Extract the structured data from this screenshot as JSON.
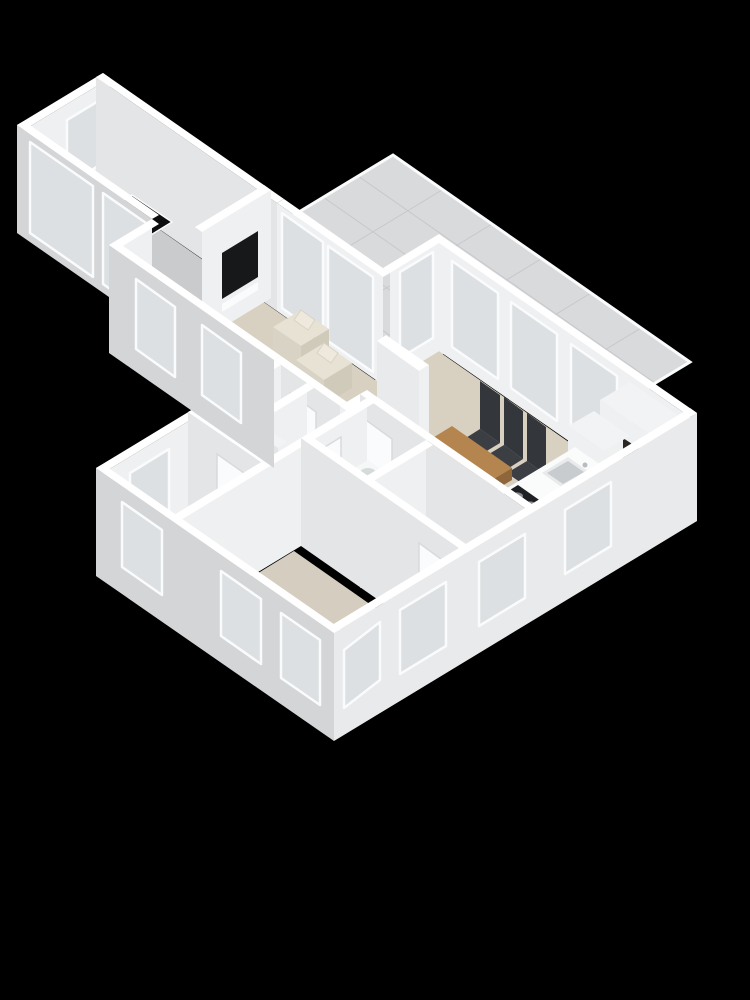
{
  "scene": {
    "type": "3d-floorplan-render",
    "view": "isometric-top",
    "background": "#000000",
    "description": "3D rendered floor plan of an apartment on black background: large tiled roof terrace top-right, narrow study wing on the left, open living/dining/kitchen area in the middle, hallway with stairs, WC, utility room, bathroom and two bedrooms in the lower block."
  },
  "palette": {
    "bg": "#000000",
    "wall_top": "#ffffff",
    "wall_int": "#eff0f1",
    "wall_int_shade": "#e3e5e7",
    "wall_sw": "#d3d5d7",
    "wall_se": "#e9eaeb",
    "frame": "#fafbfc",
    "glass": "#dde0e2",
    "terrace_tile": "#d9dadc",
    "terrace_grid": "#c6c8cb",
    "floor_living": "#d8d1c2",
    "floor_wing": "#c9cbcc",
    "floor_hall": "#cdc5b6",
    "floor_bed1": "#d3ccbd",
    "floor_bed2": "#d5cec0",
    "floor_utility": "#c5c7c9",
    "floor_bath": "#c8cacc",
    "floor_wc": "#c2c4c6",
    "rug": "#c6c7c5",
    "sofa": "#b7bbbe",
    "sofa_side": "#aeb2b5",
    "armchair": "#e7e2d4",
    "armchair_shade": "#d8d3c4",
    "armchair_side": "#cfcaba",
    "wood": "#b5854f",
    "wood_dark": "#96693f",
    "wood_side": "#8e6639",
    "chair_dark": "#3b3e42",
    "chair_darker": "#33363a",
    "tv": "#17181a",
    "counter": "#fafbfb",
    "stove": "#1e2023",
    "oven": "#2a2624",
    "desk_top": "#0d0e10",
    "appliance": "#f2f3f4"
  },
  "rooms": [
    {
      "name": "roof-terrace",
      "floor": "terrace_tile",
      "features": "tiled surface with grid joints"
    },
    {
      "name": "study-wing",
      "floor": "floor_wing",
      "features": "drafting desk, window, glass doors"
    },
    {
      "name": "living-room",
      "floor": "floor_living",
      "features": "rug, sofa, coffee table, two armchairs, wall TV"
    },
    {
      "name": "dining-area",
      "floor": "floor_living",
      "features": "wooden table, five dark chairs"
    },
    {
      "name": "kitchen",
      "floor": "floor_living",
      "features": "peninsula with sink and cooktop, tall cabinets with oven"
    },
    {
      "name": "hallway",
      "floor": "floor_hall",
      "features": "staircase, interior doors"
    },
    {
      "name": "wc",
      "floor": "floor_wc",
      "features": "toilet"
    },
    {
      "name": "utility-room",
      "floor": "floor_utility",
      "features": "washing machine, small sink"
    },
    {
      "name": "bathroom",
      "floor": "floor_bath",
      "features": ""
    },
    {
      "name": "bedroom-1",
      "floor": "floor_bed1",
      "features": "window"
    },
    {
      "name": "bedroom-2",
      "floor": "floor_bed2",
      "features": "windows on two walls"
    }
  ],
  "furniture_counts": {
    "armchairs": 2,
    "dining_chairs": 5,
    "stair_steps": 5,
    "terrace_grid_lines": 9,
    "windows_total": 14
  }
}
